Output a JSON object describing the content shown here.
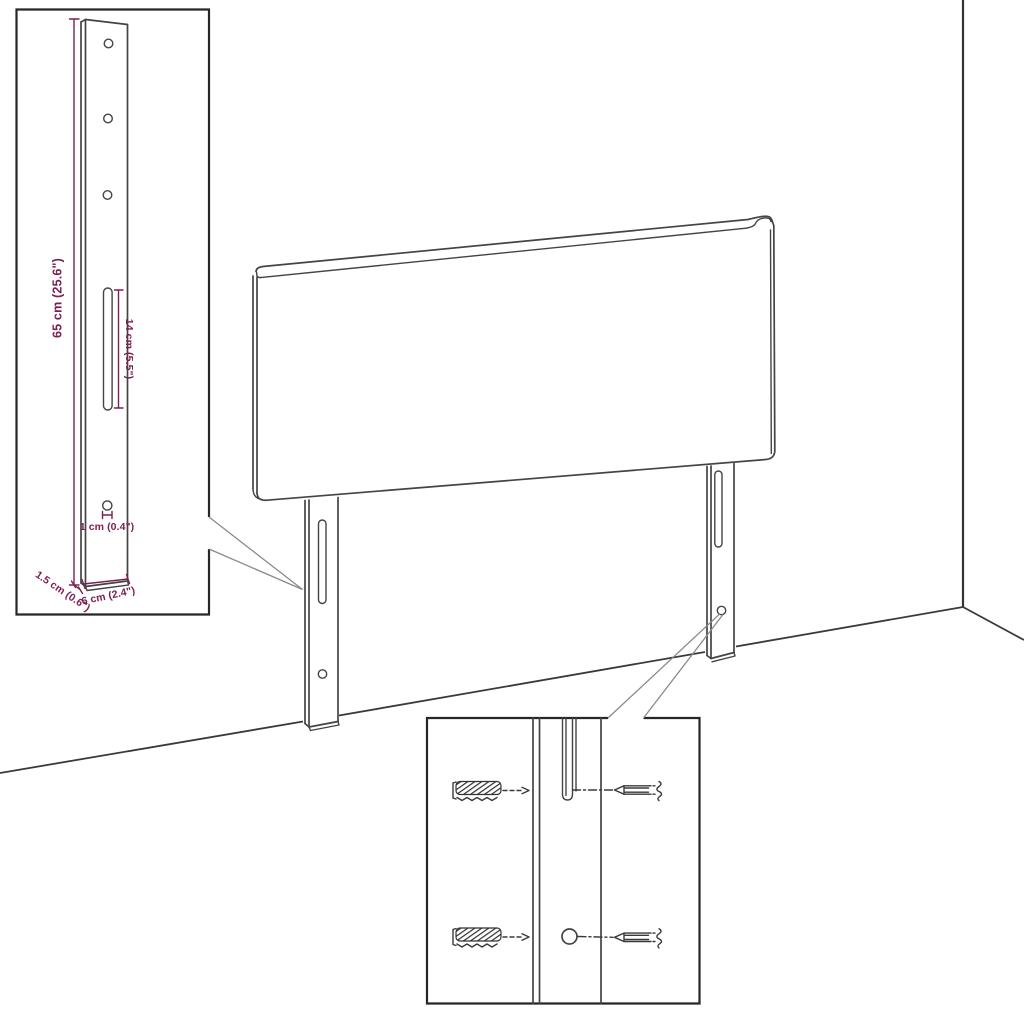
{
  "page": {
    "background": "#ffffff"
  },
  "diagram": {
    "subject": "headboard-with-mounting-legs-assembly-diagram",
    "line_color": "#444444",
    "dimension_color": "#7a2153"
  },
  "labels": {
    "leg_height": "65 cm (25.6\")",
    "slot_length": "14 cm (5.5\")",
    "hole_diameter": "1 cm (0.4\")",
    "leg_thickness": "1.5 cm (0.6\")",
    "leg_width": "6 cm (2.4\")"
  }
}
